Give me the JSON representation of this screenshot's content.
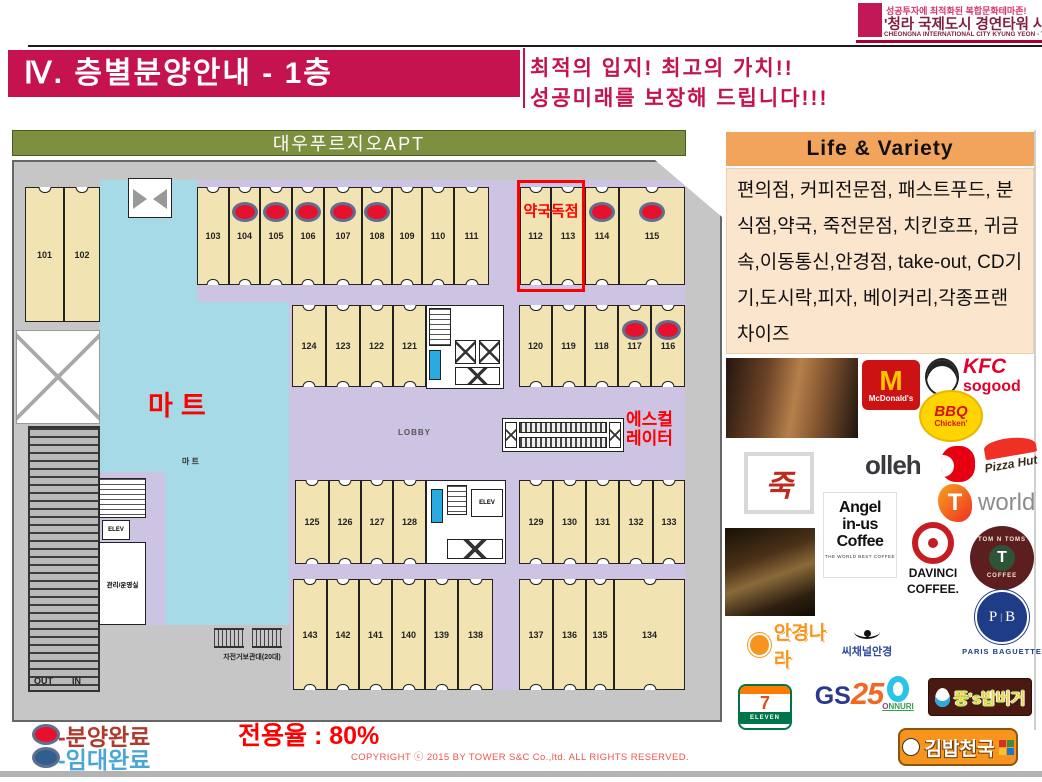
{
  "header": {
    "badge_line1": "성공투자에 최적화된 복합문화테마존!",
    "badge_line2": "'청라 국제도시 경연타워 사업설명서",
    "badge_line3": "CHEONGNA INTERNATIONAL CITY KYUNG YEON - TOWER PROSPECTUS",
    "title": "Ⅳ. 층별분양안내 - 1층",
    "slogan_line1": "최적의 입지!  최고의 가치!!",
    "slogan_line2": "성공미래를 보장해 드립니다!!!"
  },
  "plan": {
    "apt_label": "대우푸르지오APT",
    "mart_label": "마트",
    "mart_small": "마 트",
    "lobby_label": "LOBBY",
    "escalator_line1": "에스컬",
    "escalator_line2": "레이터",
    "pharmacy_label": "약국독점",
    "elev_label": "ELEV",
    "out_label": "OUT",
    "in_label": "IN",
    "bike_label": "자전거보관대(20대)",
    "mgmt_label": "관리/운영실",
    "units": [
      {
        "n": "101",
        "x": 11,
        "y": 25,
        "w": 39,
        "h": 135,
        "door": "top",
        "dot": false
      },
      {
        "n": "102",
        "x": 50,
        "y": 25,
        "w": 36,
        "h": 135,
        "door": "top",
        "dot": false
      },
      {
        "n": "103",
        "x": 183,
        "y": 25,
        "w": 32,
        "h": 98,
        "door": "both",
        "dot": false
      },
      {
        "n": "104",
        "x": 215,
        "y": 25,
        "w": 31,
        "h": 98,
        "door": "both",
        "dot": true
      },
      {
        "n": "105",
        "x": 246,
        "y": 25,
        "w": 32,
        "h": 98,
        "door": "both",
        "dot": true
      },
      {
        "n": "106",
        "x": 278,
        "y": 25,
        "w": 32,
        "h": 98,
        "door": "both",
        "dot": true
      },
      {
        "n": "107",
        "x": 310,
        "y": 25,
        "w": 38,
        "h": 98,
        "door": "both",
        "dot": true
      },
      {
        "n": "108",
        "x": 348,
        "y": 25,
        "w": 30,
        "h": 98,
        "door": "both",
        "dot": true
      },
      {
        "n": "109",
        "x": 378,
        "y": 25,
        "w": 30,
        "h": 98,
        "door": "both",
        "dot": false
      },
      {
        "n": "110",
        "x": 408,
        "y": 25,
        "w": 32,
        "h": 98,
        "door": "both",
        "dot": false
      },
      {
        "n": "111",
        "x": 440,
        "y": 25,
        "w": 35,
        "h": 98,
        "door": "both",
        "dot": false
      },
      {
        "n": "112",
        "x": 506,
        "y": 25,
        "w": 31,
        "h": 98,
        "door": "both",
        "dot": false
      },
      {
        "n": "113",
        "x": 537,
        "y": 25,
        "w": 34,
        "h": 98,
        "door": "both",
        "dot": false
      },
      {
        "n": "114",
        "x": 571,
        "y": 25,
        "w": 34,
        "h": 98,
        "door": "both",
        "dot": true
      },
      {
        "n": "115",
        "x": 605,
        "y": 25,
        "w": 66,
        "h": 98,
        "door": "both",
        "dot": true
      },
      {
        "n": "124",
        "x": 278,
        "y": 143,
        "w": 34,
        "h": 82,
        "door": "both",
        "dot": false
      },
      {
        "n": "123",
        "x": 312,
        "y": 143,
        "w": 34,
        "h": 82,
        "door": "both",
        "dot": false
      },
      {
        "n": "122",
        "x": 346,
        "y": 143,
        "w": 33,
        "h": 82,
        "door": "both",
        "dot": false
      },
      {
        "n": "121",
        "x": 379,
        "y": 143,
        "w": 33,
        "h": 82,
        "door": "both",
        "dot": false
      },
      {
        "n": "120",
        "x": 505,
        "y": 143,
        "w": 33,
        "h": 82,
        "door": "both",
        "dot": false
      },
      {
        "n": "119",
        "x": 538,
        "y": 143,
        "w": 33,
        "h": 82,
        "door": "both",
        "dot": false
      },
      {
        "n": "118",
        "x": 571,
        "y": 143,
        "w": 33,
        "h": 82,
        "door": "both",
        "dot": false
      },
      {
        "n": "117",
        "x": 604,
        "y": 143,
        "w": 33,
        "h": 82,
        "door": "both",
        "dot": true
      },
      {
        "n": "116",
        "x": 637,
        "y": 143,
        "w": 34,
        "h": 82,
        "door": "both",
        "dot": true
      },
      {
        "n": "125",
        "x": 281,
        "y": 318,
        "w": 34,
        "h": 84,
        "door": "both",
        "dot": false
      },
      {
        "n": "126",
        "x": 315,
        "y": 318,
        "w": 32,
        "h": 84,
        "door": "both",
        "dot": false
      },
      {
        "n": "127",
        "x": 347,
        "y": 318,
        "w": 32,
        "h": 84,
        "door": "both",
        "dot": false
      },
      {
        "n": "128",
        "x": 379,
        "y": 318,
        "w": 33,
        "h": 84,
        "door": "both",
        "dot": false
      },
      {
        "n": "129",
        "x": 505,
        "y": 318,
        "w": 34,
        "h": 84,
        "door": "both",
        "dot": false
      },
      {
        "n": "130",
        "x": 539,
        "y": 318,
        "w": 33,
        "h": 84,
        "door": "both",
        "dot": false
      },
      {
        "n": "131",
        "x": 572,
        "y": 318,
        "w": 33,
        "h": 84,
        "door": "both",
        "dot": false
      },
      {
        "n": "132",
        "x": 605,
        "y": 318,
        "w": 34,
        "h": 84,
        "door": "both",
        "dot": false
      },
      {
        "n": "133",
        "x": 639,
        "y": 318,
        "w": 32,
        "h": 84,
        "door": "both",
        "dot": false
      },
      {
        "n": "143",
        "x": 279,
        "y": 417,
        "w": 34,
        "h": 111,
        "door": "both",
        "dot": false
      },
      {
        "n": "142",
        "x": 313,
        "y": 417,
        "w": 32,
        "h": 111,
        "door": "both",
        "dot": false
      },
      {
        "n": "141",
        "x": 345,
        "y": 417,
        "w": 33,
        "h": 111,
        "door": "both",
        "dot": false
      },
      {
        "n": "140",
        "x": 378,
        "y": 417,
        "w": 33,
        "h": 111,
        "door": "both",
        "dot": false
      },
      {
        "n": "139",
        "x": 411,
        "y": 417,
        "w": 33,
        "h": 111,
        "door": "both",
        "dot": false
      },
      {
        "n": "138",
        "x": 444,
        "y": 417,
        "w": 35,
        "h": 111,
        "door": "both",
        "dot": false
      },
      {
        "n": "137",
        "x": 505,
        "y": 417,
        "w": 34,
        "h": 111,
        "door": "both",
        "dot": false
      },
      {
        "n": "136",
        "x": 539,
        "y": 417,
        "w": 33,
        "h": 111,
        "door": "both",
        "dot": false
      },
      {
        "n": "135",
        "x": 572,
        "y": 417,
        "w": 28,
        "h": 111,
        "door": "both",
        "dot": false
      },
      {
        "n": "134",
        "x": 600,
        "y": 417,
        "w": 71,
        "h": 111,
        "door": "both",
        "dot": false
      }
    ]
  },
  "legend": {
    "sold_label": "-분양완료",
    "leased_label": "-임대완료",
    "sold_dot_color": "#E8112D",
    "leased_dot_color": "#2F5F8F",
    "sold_text_color": "#B03A2E",
    "leased_text_color": "#4BA6D8",
    "rate_label": "전용율 : 80%"
  },
  "life": {
    "title": "Life & Variety",
    "body": "편의점, 커피전문점, 패스트푸드, 분식점,약국, 죽전문점, 치킨호프, 귀금속,이동통신,안경점, take-out,  CD기기,도시락,피자, 베이커리,각종프랜차이즈"
  },
  "brands": {
    "mcdonalds": {
      "m": "M",
      "name": "McDonald's"
    },
    "kfc": {
      "name": "KFC",
      "tagline": "sogood"
    },
    "bbq": {
      "top": "BBQ",
      "bottom": "Chicken'"
    },
    "olleh": {
      "name": "olleh"
    },
    "pizzahut": {
      "name": "Pizza Hut"
    },
    "juk": {
      "char": "죽"
    },
    "tworld": {
      "t": "T",
      "name": "world"
    },
    "angelinus": {
      "l1": "Angel",
      "l2": "in-us",
      "l3": "Coffee",
      "sub": "THE WORLD BEST COFFEE"
    },
    "davinci": {
      "l1": "DAVINCI",
      "l2": "COFFEE."
    },
    "tomntoms": {
      "arc": "TOM N TOMS",
      "t": "T",
      "sub": "COFFEE"
    },
    "parisbaguette": {
      "p": "P",
      "b": "B",
      "name": "PARIS BAGUETTE"
    },
    "angyeongnara": {
      "name": "안경나라"
    },
    "cchannel": {
      "name": "씨채널안경"
    },
    "seveneleven": {
      "seven": "7",
      "name": "ELEVEN"
    },
    "gs25": {
      "gs": "GS",
      "n25": "25"
    },
    "onnuri": {
      "name": "ONNURI"
    },
    "ddung": {
      "name": "뚱's밥버거"
    },
    "kimbap": {
      "name": "김밥천국"
    }
  },
  "footer": {
    "copyright": "COPYRIGHT ⓒ 2015 BY TOWER S&C Co.,ltd. ALL RIGHTS RESERVED."
  }
}
